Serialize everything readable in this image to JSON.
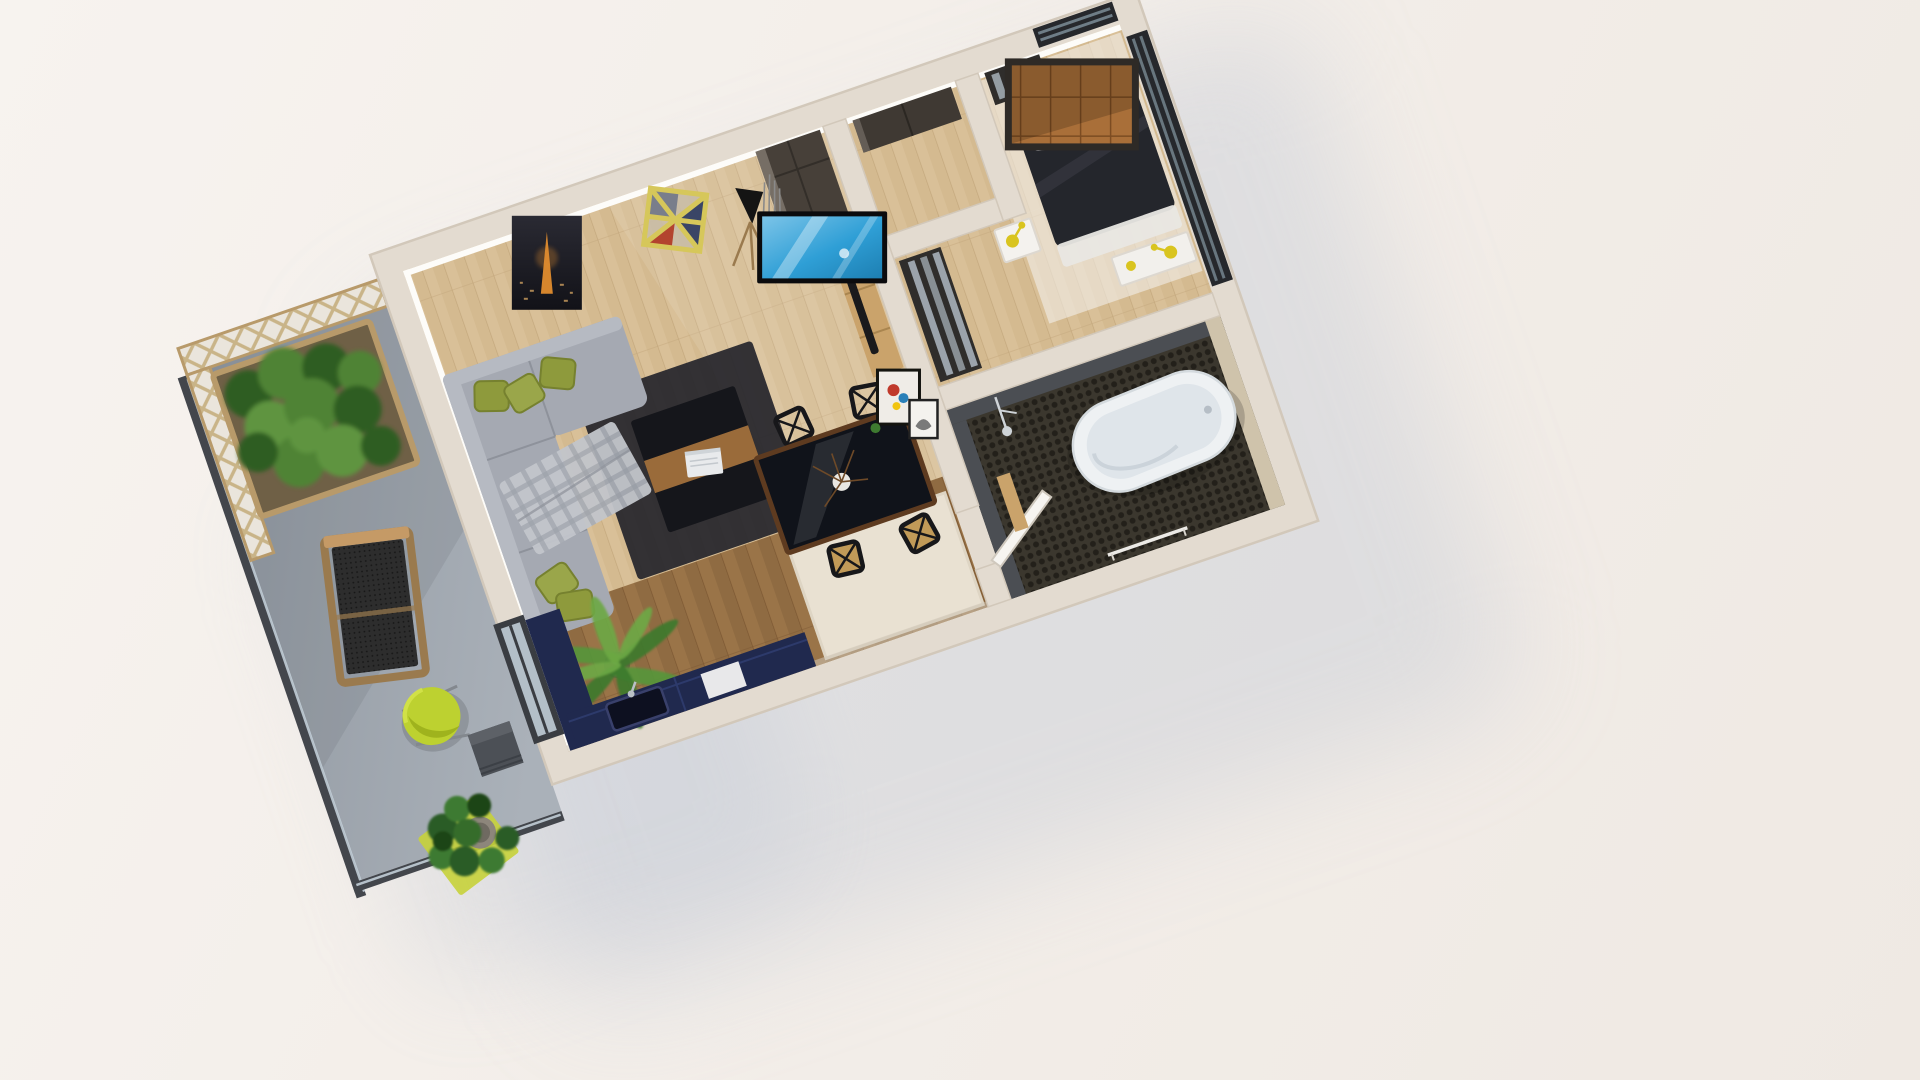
{
  "scene": {
    "type": "3d-isometric-floorplan-render",
    "description": "Cutaway 3D floor plan of a one-bedroom apartment with balcony terrace, viewed from above at an angle on a pale studio background with a soft blue-gray cast shadow",
    "rotation_deg": -19,
    "rooms": [
      {
        "name": "living-room",
        "floor": "light-oak-planks",
        "objects": [
          "gray-sectional-sofa",
          "olive-pillows",
          "plaid-throw",
          "dark-area-rug",
          "coffee-table-with-laptop",
          "tripod-floor-lamp",
          "tall-dark-wardrobe",
          "decor-sticks",
          "eiffel-night-poster",
          "geometric-yellow-wall-shelf",
          "wall-tv",
          "tv-console-with-soundbar",
          "leaning-art-frames",
          "potted-palm",
          "dining-table-with-branch-vase",
          "four-black-x-back-chairs"
        ]
      },
      {
        "name": "kitchen-nook",
        "floor": "dark-wood-planks",
        "objects": [
          "navy-l-shaped-cabinets",
          "dark-sink",
          "faucet",
          "cream-rug",
          "white-appliance-panel"
        ]
      },
      {
        "name": "entry-hall",
        "floor": "light-oak-planks",
        "objects": [
          "dark-sideboard"
        ]
      },
      {
        "name": "bedroom",
        "floor": "oak-with-white-rug",
        "objects": [
          "double-bed-dark-duvet",
          "check-pillows",
          "leather-panel-headboard",
          "mirrored-wardrobes",
          "white-nightstand",
          "white-bench",
          "yellow-task-lamps",
          "corner-windows"
        ]
      },
      {
        "name": "bathroom",
        "floor": "dark-mosaic-tile",
        "objects": [
          "freestanding-oval-bathtub",
          "shower-fixture",
          "open-white-door",
          "towel-rail",
          "slate-tile-walls",
          "beige-tile-wall"
        ]
      },
      {
        "name": "balcony-terrace",
        "floor": "concrete",
        "objects": [
          "wood-trellis-panels",
          "glass-balustrade",
          "hedge-in-wood-planter",
          "wooden-lounge-chair-black-mesh",
          "lime-egg-chair",
          "cube-side-table",
          "lime-mat",
          "fiddle-leaf-plant-stone-pot"
        ]
      }
    ]
  },
  "palette": {
    "bg": "#f3eee9",
    "shadow": "rgba(183,192,208,0.55)",
    "wallTop": "#e3dbd0",
    "wallEdge": "#d2c8ba",
    "wallFace": "#fdfcf9",
    "wallShade": "#cfc6b8",
    "oak": "#d9c098",
    "oakLine": "#c3a77c",
    "woodDark": "#9a7448",
    "woodDarkLine": "#7b5732",
    "rugCream": "#e9e1d2",
    "rugCreamEdge": "#ded5c4",
    "rugDark": "#26262c",
    "concrete": "#9ba2ab",
    "concreteDark": "#848b94",
    "balustrade": "#43464c",
    "glass": "#c9d6df",
    "trellisWood": "#c9b488",
    "trellisBack": "#eae5dc",
    "planterWood": "#b89a6a",
    "planterSoil": "#6f6046",
    "hedge1": "#2f5d24",
    "hedge2": "#4f8336",
    "hedge3": "#5f9440",
    "sofa": "#a5a9b2",
    "sofaBack": "#b6bac2",
    "sofaSeam": "#8e929b",
    "olive": "#8e9a3c",
    "oliveEdge": "#76812f",
    "plaidBase": "#c2c5cb",
    "plaidLine": "#9fa3ab",
    "tableDark": "#15161b",
    "tableWood": "#9a6b3a",
    "diningTop": "#10131a",
    "diningRim": "#5e3b20",
    "chairBlack": "#17171a",
    "seatTan": "#c19a58",
    "navy": "#20294e",
    "navyLine": "#2d3a6b",
    "sinkDark": "#0d1020",
    "tvFrame": "#0b0b0d",
    "tvBlue": "#2f9fd6",
    "tvBlueLight": "#7cc4e8",
    "consoleWood": "#caa36b",
    "soundbar": "#1a1a1c",
    "posterDark": "#1c1c24",
    "towerOrange": "#e08c2e",
    "shelfYellow": "#d6c75a",
    "shelfRed": "#b3442e",
    "shelfNavy": "#3a4566",
    "shelfBeige": "#c9bca6",
    "shelfSlate": "#6b7386",
    "lampBlack": "#141414",
    "woodLeg": "#9a7a4e",
    "headboardWood": "#a96f39",
    "headboardLine": "#7c4c22",
    "headboardFrame": "#2e2a26",
    "bedDark": "#24262c",
    "sheetWhite": "#e9e7e3",
    "nightstand": "#f4f2ee",
    "lampYellow": "#d9c41f",
    "mirror": "#aeb9c2",
    "darkFurniture": "#3f3933",
    "wardrobeDark": "#474039",
    "slate": "#4b4e53",
    "beigeTile": "#cfc3ab",
    "mosaicBase": "#3b372e",
    "mosaicDot": "#23201a",
    "tub": "#eef1f3",
    "tubInner": "#dfe5ea",
    "tubEdge": "#d4dade",
    "doorWhite": "#f7f5f1",
    "lime": "#bdd130",
    "limeDark": "#9fb31d",
    "limeMat": "#c6d23a",
    "cube": "#4c5056",
    "cubeTop": "#5d6167",
    "leafDark": "#2c5b26",
    "leafMid": "#3e7a30",
    "leafPalm1": "#3c7a2c",
    "leafPalm2": "#57963b",
    "leafPalm3": "#6da844",
    "potStone": "#8d867b",
    "chrome": "#cfd4d8",
    "branch": "#6e4a28"
  }
}
